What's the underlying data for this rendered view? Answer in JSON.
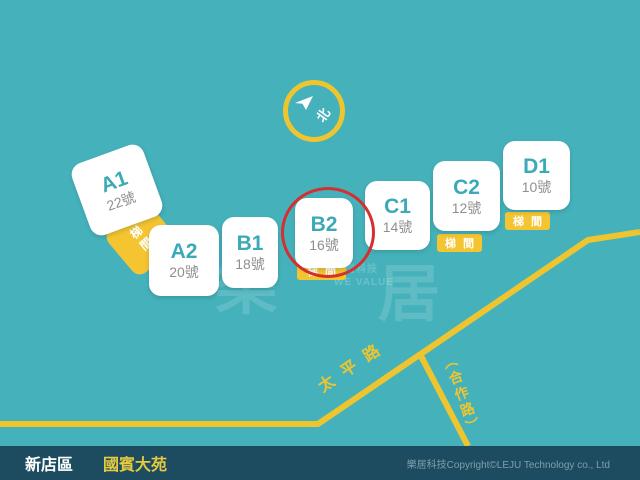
{
  "map": {
    "bg_color": "#45B2BB",
    "accent_yellow": "#F5C531",
    "highlight_red": "#D3302F",
    "compass": {
      "north_label": "北"
    },
    "buildings": [
      {
        "name": "A1",
        "number": "22號",
        "highlighted": false
      },
      {
        "name": "A2",
        "number": "20號",
        "highlighted": false
      },
      {
        "name": "B1",
        "number": "18號",
        "highlighted": false
      },
      {
        "name": "B2",
        "number": "16號",
        "highlighted": true
      },
      {
        "name": "C1",
        "number": "14號",
        "highlighted": false
      },
      {
        "name": "C2",
        "number": "12號",
        "highlighted": false
      },
      {
        "name": "D1",
        "number": "10號",
        "highlighted": false
      }
    ],
    "stair_label": "梯間",
    "stair_label_spaced": "梯間",
    "roads": {
      "main_road_name": "太平路",
      "branch_road_name": "（合作路）"
    },
    "watermark": {
      "char1": "樂",
      "char2": "居",
      "line1": "樂居科技",
      "line2": "WE VALUE"
    }
  },
  "footer": {
    "district": "新店區",
    "community": "國賓大苑",
    "copyright": "樂居科技Copyright©LEJU Technology co., Ltd"
  }
}
